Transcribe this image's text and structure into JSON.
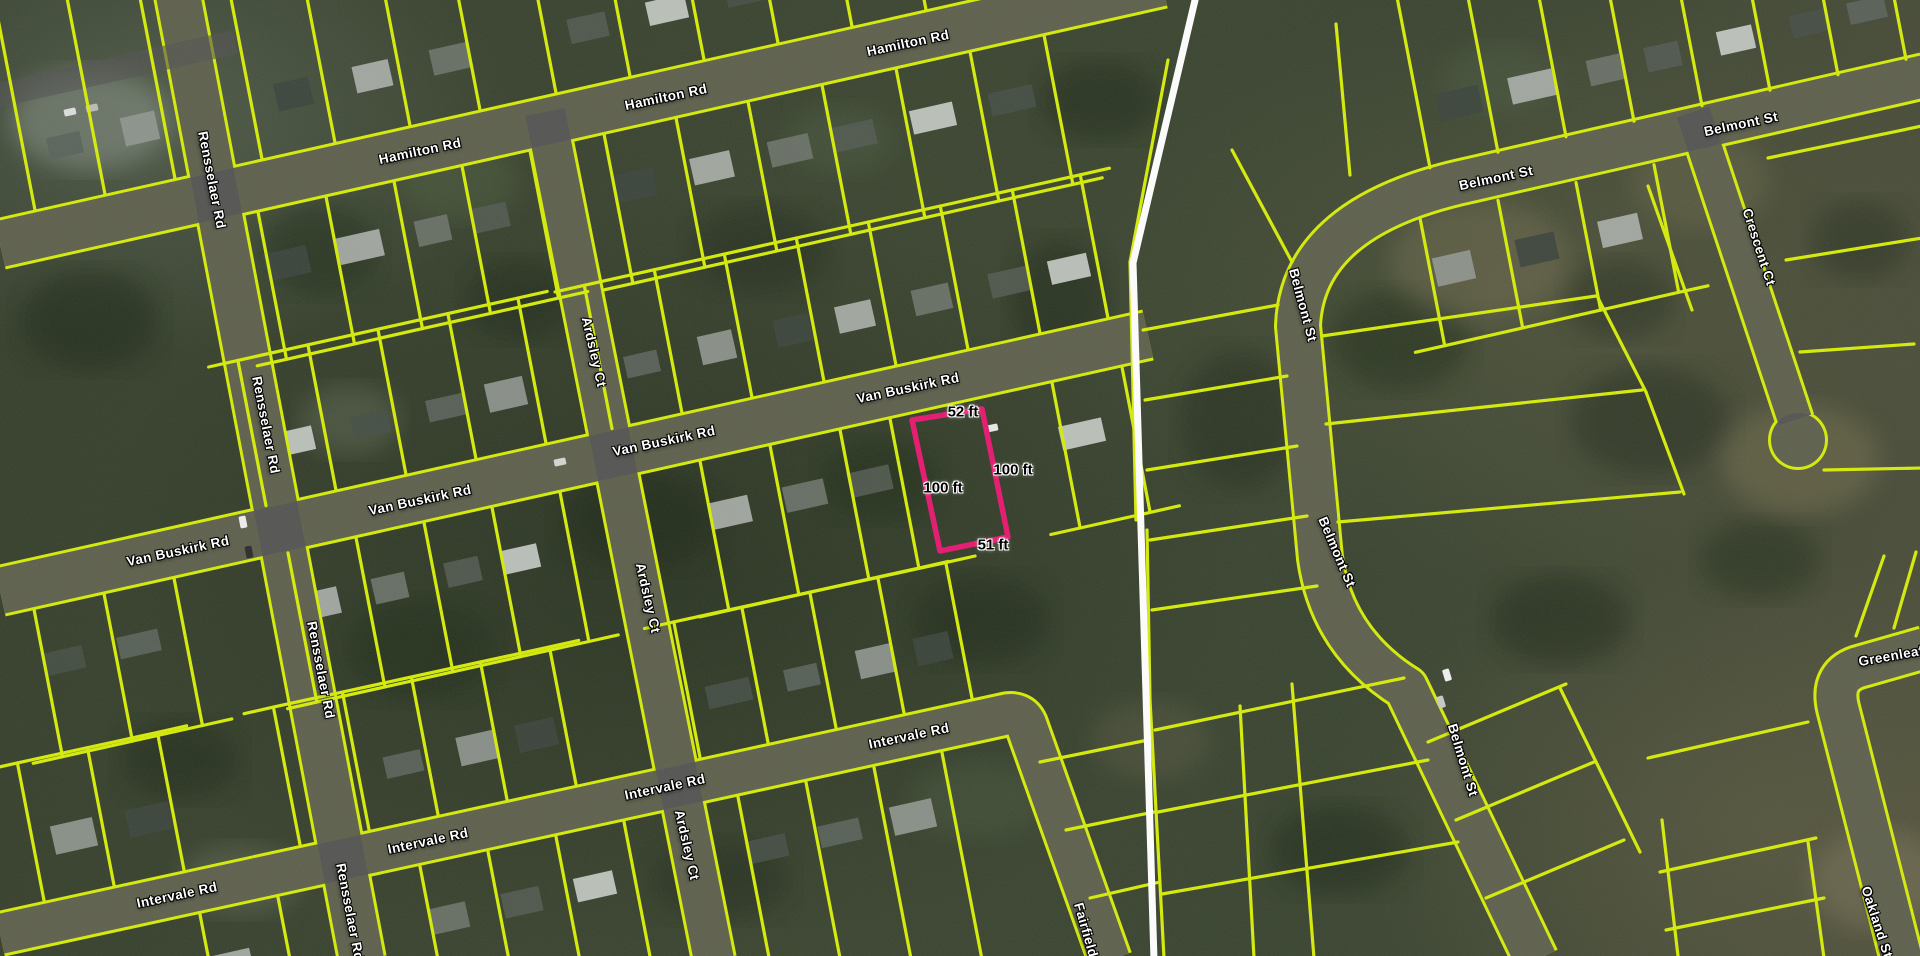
{
  "map": {
    "streets": [
      {
        "label": "Hamilton Rd",
        "x": 420,
        "y": 151,
        "r": -12
      },
      {
        "label": "Hamilton Rd",
        "x": 666,
        "y": 97,
        "r": -12
      },
      {
        "label": "Hamilton Rd",
        "x": 908,
        "y": 43,
        "r": -12
      },
      {
        "label": "Van Buskirk Rd",
        "x": 178,
        "y": 551,
        "r": -12
      },
      {
        "label": "Van Buskirk Rd",
        "x": 420,
        "y": 500,
        "r": -12
      },
      {
        "label": "Van Buskirk Rd",
        "x": 664,
        "y": 441,
        "r": -12
      },
      {
        "label": "Van Buskirk Rd",
        "x": 908,
        "y": 388,
        "r": -12
      },
      {
        "label": "Intervale Rd",
        "x": 177,
        "y": 895,
        "r": -12
      },
      {
        "label": "Intervale Rd",
        "x": 428,
        "y": 841,
        "r": -12
      },
      {
        "label": "Intervale Rd",
        "x": 665,
        "y": 787,
        "r": -12
      },
      {
        "label": "Intervale Rd",
        "x": 909,
        "y": 736,
        "r": -12
      },
      {
        "label": "Rensselaer Rd",
        "x": 212,
        "y": 180,
        "r": 79
      },
      {
        "label": "Rensselaer Rd",
        "x": 266,
        "y": 425,
        "r": 79
      },
      {
        "label": "Rensselaer Rd",
        "x": 321,
        "y": 670,
        "r": 79
      },
      {
        "label": "Rensselaer Rd",
        "x": 350,
        "y": 912,
        "r": 79
      },
      {
        "label": "Ardsley Ct",
        "x": 594,
        "y": 352,
        "r": 77
      },
      {
        "label": "Ardsley Ct",
        "x": 648,
        "y": 598,
        "r": 77
      },
      {
        "label": "Ardsley Ct",
        "x": 687,
        "y": 845,
        "r": 77
      },
      {
        "label": "Fairfield",
        "x": 1086,
        "y": 930,
        "r": 74
      },
      {
        "label": "Belmont St",
        "x": 1496,
        "y": 178,
        "r": -12
      },
      {
        "label": "Belmont St",
        "x": 1741,
        "y": 124,
        "r": -12
      },
      {
        "label": "Belmont St",
        "x": 1303,
        "y": 305,
        "r": 75
      },
      {
        "label": "Belmont St",
        "x": 1337,
        "y": 552,
        "r": 67
      },
      {
        "label": "Belmont St",
        "x": 1463,
        "y": 760,
        "r": 73
      },
      {
        "label": "Crescent Ct",
        "x": 1759,
        "y": 247,
        "r": 72
      },
      {
        "label": "Greenleaf",
        "x": 1891,
        "y": 656,
        "r": -10
      },
      {
        "label": "Oakland St",
        "x": 1877,
        "y": 922,
        "r": 72
      }
    ],
    "selected_parcel": {
      "dimensions": [
        {
          "label": "52 ft",
          "x": 963,
          "y": 412
        },
        {
          "label": "100 ft",
          "x": 1013,
          "y": 470
        },
        {
          "label": "100 ft",
          "x": 943,
          "y": 488
        },
        {
          "label": "51 ft",
          "x": 993,
          "y": 545
        }
      ],
      "outline_points": "912,420 982,409 1008,537 940,551"
    },
    "colors": {
      "parcel_line": "#d6ec07",
      "selected_parcel": "#e6166e",
      "road_overlay": "#525252",
      "boundary_line": "#ffffff",
      "street_label_text": "#ffffff",
      "dimension_label_text": "#000000"
    }
  }
}
